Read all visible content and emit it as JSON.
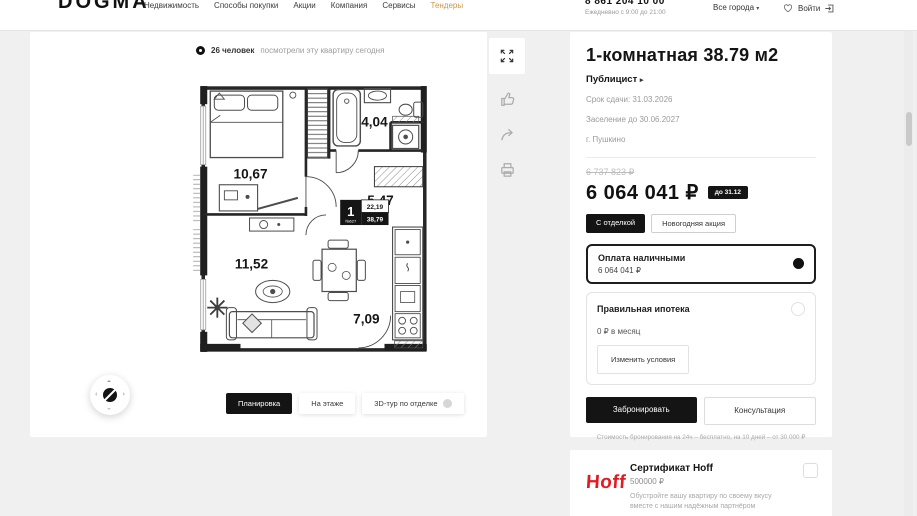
{
  "header": {
    "logo": "DOGMA",
    "nav": [
      "Недвижимость",
      "Способы покупки",
      "Акции",
      "Компания",
      "Сервисы",
      "Тендеры"
    ],
    "phone": "8 861 204 10 00",
    "schedule": "Ежедневно с 9:00 до 21:00",
    "city_selector": "Все города",
    "login_label": "Войти"
  },
  "viewer": {
    "views_count": "26 человек",
    "views_text": "посмотрели эту квартиру сегодня",
    "tabs": [
      "Планировка",
      "На этаже",
      "3D-тур по отделке"
    ],
    "plan": {
      "unit_number": "1",
      "unit_code": "№627",
      "area_living": "22,19",
      "area_total": "38,79",
      "rooms": {
        "bedroom": "10,67",
        "bathroom": "4,04",
        "hallway": "5,47",
        "living": "11,52",
        "kitchen": "7,09"
      }
    },
    "icons": [
      "eye-icon",
      "fullscreen-icon",
      "like-icon",
      "share-icon",
      "print-icon",
      "compass-icon",
      "lock-icon"
    ]
  },
  "details": {
    "title": "1-комнатная 38.79 м2",
    "project": "Публицист",
    "deadline": "Срок сдачи: 31.03.2026",
    "settlement": "Заселение до 30.06.2027",
    "city": "г. Пушкино",
    "old_price": "6 737 823 ₽",
    "price": "6 064 041 ₽",
    "price_badge": "до 31.12",
    "tags": [
      "С отделкой",
      "Новогодняя акция"
    ],
    "payment": {
      "cash_title": "Оплата наличными",
      "cash_value": "6 064 041 ₽",
      "mortgage_title": "Правильная ипотека",
      "mortgage_monthly": "0 ₽ в месяц",
      "mortgage_action": "Изменить условия"
    },
    "book_button": "Забронировать",
    "consult_button": "Консультация",
    "booking_note": "Стоимость бронирования на 24ч – бесплатно, на 10 дней – от 30 000 ₽"
  },
  "hoff": {
    "logo": "Hoff",
    "title": "Сертификат Hoff",
    "amount": "500000 ₽",
    "description": "Обустройте вашу квартиру по своему вкусу вместе с нашим надёжным партнёром"
  },
  "colors": {
    "accent": "#cf9640",
    "hoff_red": "#e21a22",
    "dark": "#141414"
  }
}
